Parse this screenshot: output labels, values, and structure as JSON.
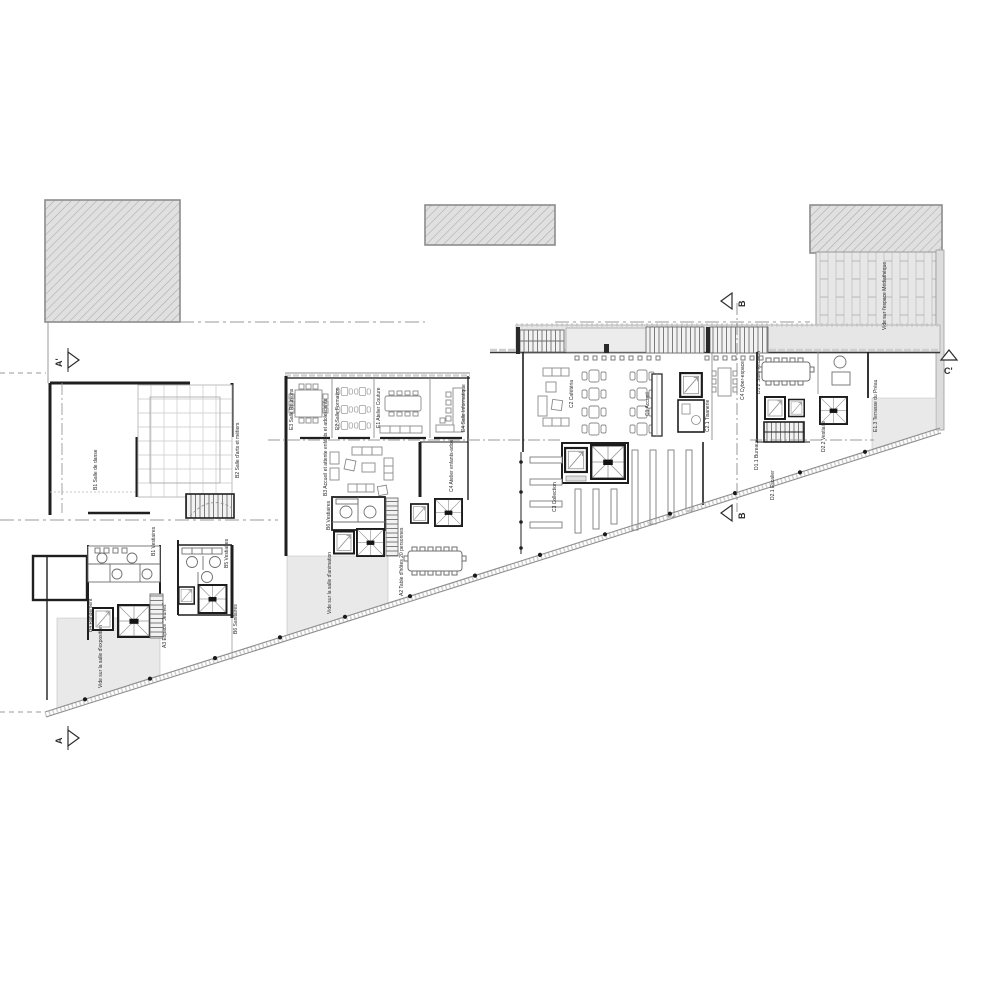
{
  "markers": {
    "a_prime": "A'",
    "a": "A",
    "b_top": "B",
    "b_bottom": "B",
    "c_prime": "C'"
  },
  "labels": {
    "salle_danse": "B1 Salle de danse",
    "salle_arts": "B2 Salle d'arts et métiers",
    "salle_reunions": "E3 Salle Réunions",
    "salle_formation": "E2 Salle Formation",
    "atelier_couture": "E1 Atelier Couture",
    "salle_informatique": "E4 Salle Informatique",
    "accueil_attente": "B3 Accueil et attente enfants et adolescents",
    "atelier_enfants": "C4 Atelier enfants-ados",
    "vestiaires_1": "B1 Vestiaires",
    "rangement": "B4 Rangement",
    "vide_exposition": "Vide sur la salle d'exposition",
    "espace_jeunes": "A3 Espace \"Jeunes\"",
    "vestiaires_2": "B5 Vestiaires",
    "sanitaires": "B6 Sanitaires",
    "vestiaires_3": "B6 Vestiaires",
    "terrasse_table": "A2 Table d'hôtes 20 personnes",
    "vide_animation": "Vide sur la salle d'animation",
    "cafeteria": "C2 Cafétéria",
    "accueil": "C1 Accueil",
    "tisanerie": "C2.1 Tisanerie",
    "cyber": "C4 Cyber-espace",
    "collection": "C3 Collection",
    "salle_reunion_d": "D1.2 Salle Réunion",
    "bureau": "D1.1 Bureaux",
    "vestiaire_d": "D2.2 Vestiaire",
    "escalier_d": "D2.1 Escalier",
    "vide_mediatheque": "Vide sur l'espace Médiathèque",
    "terrasse_preau": "E1.3 Terrasse du Préau"
  }
}
